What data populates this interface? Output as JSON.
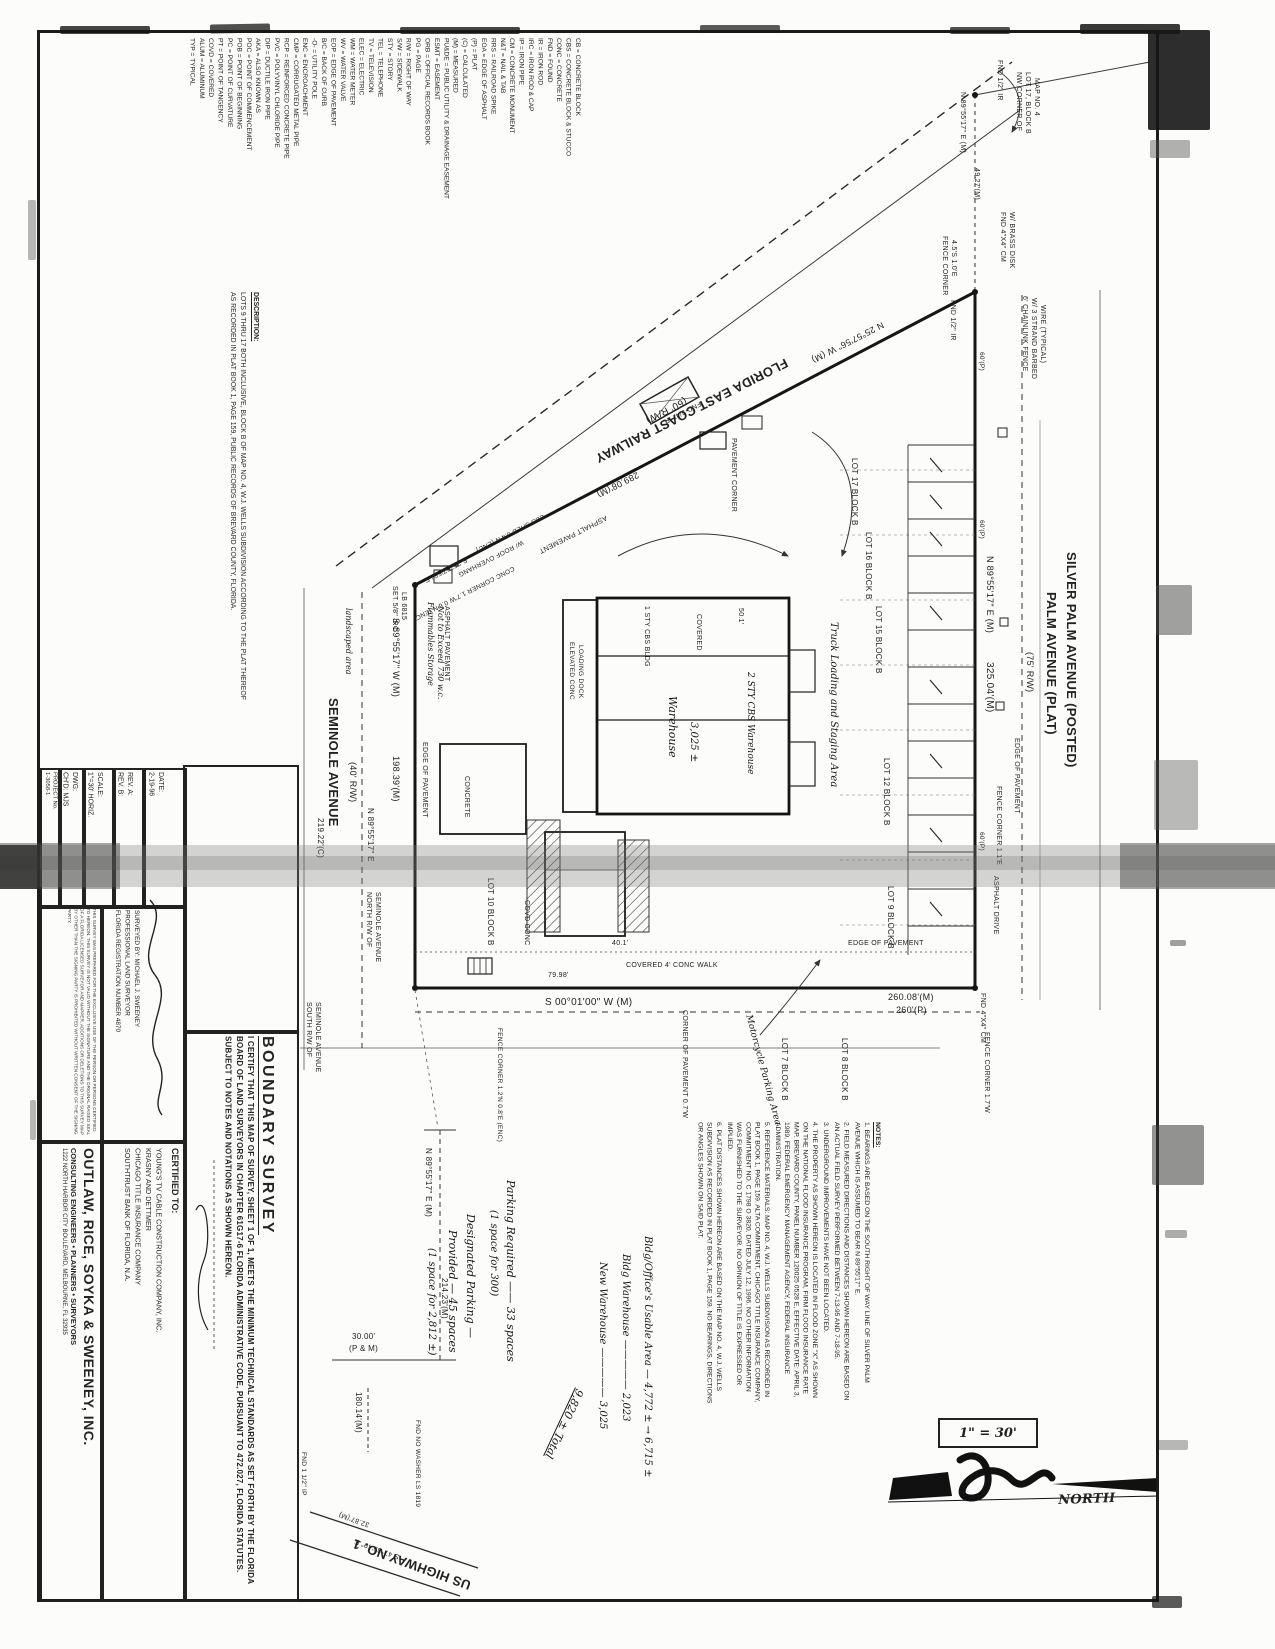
{
  "document": {
    "title": "BOUNDARY SURVEY",
    "certification_statement": "I CERTIFY THAT THIS MAP OF SURVEY, SHEET 1 OF 1, MEETS THE MINIMUM TECHNICAL STANDARDS AS SET FORTH BY THE FLORIDA BOARD OF LAND SURVEYORS IN CHAPTER 61G17-6 FLORIDA ADMINISTRATIVE CODE, PURSUANT TO 472.027, FLORIDA STATUTES. SUBJECT TO NOTES AND NOTATIONS AS SHOWN HEREON.",
    "certified_to_label": "CERTIFIED TO:",
    "certified_to": [
      "YOUNG'S TV CABLE CONSTRUCTION COMPANY, INC.",
      "KRASNY AND DETTMER",
      "CHICAGO TITLE INSURANCE COMPANY",
      "SOUTHTRUST BANK OF FLORIDA, N.A."
    ]
  },
  "company": {
    "name": "OUTLAW, RICE, SOYKA & SWEENEY, INC.",
    "tagline": "CONSULTING ENGINEERS • PLANNERS • SURVEYORS",
    "address": "1222 NORTH HARBOR CITY BOULEVARD, MELBOURNE, FL 32935"
  },
  "title_block": {
    "date_label": "DATE:",
    "date": "2-19-96",
    "rev_a": "REV. A:",
    "rev_b": "REV. B:",
    "scale_label": "SCALE:",
    "scale": "1\"=30' HORIZ.",
    "dwg_label": "DWG:",
    "chd_label": "CH'D: MJS",
    "project_label": "PROJECT No.",
    "project": "1-3058-1",
    "surveyed_by": "SURVEYED BY: MICHAEL J. SWEENEY",
    "surveyor_title": "PROFESSIONAL LAND SURVEYOR",
    "registration": "FLORIDA REGISTRATION NUMBER 4870",
    "disclaimer": "THIS SURVEY WAS PREPARED FOR THE EXCLUSIVE USE OF THE PERSON OR PERSONS CERTIFIED TO HEREON. THIS SURVEY IS NOT VALID WITHOUT THE SIGNATURE AND THE ORIGINAL RAISED SEAL OF A FLORIDA LICENSED SURVEYOR AND MAPPER. ADDITIONS OR DELETIONS TO THIS SURVEY MAP BY OTHER THAN THE SIGNING PARTY IS PROHIBITED WITHOUT WRITTEN CONSENT OF THE SIGNING PARTY."
  },
  "legend": {
    "items": [
      "CB = CONCRETE BLOCK",
      "CBS = CONCRETE BLOCK & STUCCO",
      "CONC = CONCRETE",
      "FND = FOUND",
      "IR = IRON ROD",
      "IRC = IRON ROD & CAP",
      "IP = IRON PIPE",
      "CM = CONCRETE MONUMENT",
      "N&T = NAIL & TAB",
      "RRS = RAILROAD SPIKE",
      "EOA = EDGE OF ASPHALT",
      "(P) = PLAT",
      "(C) = CALCULATED",
      "(M) = MEASURED",
      "PU&DE = PUBLIC UTILITY & DRAINAGE EASEMENT",
      "ESMT = EASEMENT",
      "ORB = OFFICIAL RECORDS BOOK",
      "PG = PAGE",
      "R/W = RIGHT OF WAY",
      "S/W = SIDEWALK",
      "STY = STORY",
      "TEL = TELEPHONE",
      "TV = TELEVISION",
      "ELEC = ELECTRIC",
      "WM = WATER METER",
      "WV = WATER VALVE",
      "EOP = EDGE OF PAVEMENT",
      "B/C = BACK OF CURB",
      "-O- = UTILITY POLE",
      "ENC = ENCROACHMENT",
      "CMP = CORRUGATED METAL PIPE",
      "RCP = REINFORCED CONCRETE PIPE",
      "PVC = POLYVINYL CHLORIDE PIPE",
      "DIP = DUCTILE IRON PIPE",
      "AKA = ALSO KNOWN AS",
      "POC = POINT OF COMMENCEMENT",
      "POB = POINT OF BEGINNING",
      "PC = POINT OF CURVATURE",
      "PT = POINT OF TANGENCY",
      "COVD = COVERED",
      "ALUM = ALUMINUM",
      "TYP = TYPICAL"
    ]
  },
  "description": {
    "heading": "DESCRIPTION:",
    "body": "LOTS 9 THRU 17 BOTH INCLUSIVE, BLOCK B OF MAP NO. 4, W.J. WELLS SUBDIVISION ACCORDING TO THE PLAT THEREOF AS RECORDED IN PLAT BOOK 1, PAGE 159, PUBLIC RECORDS OF BREVARD COUNTY, FLORIDA."
  },
  "notes": {
    "heading": "NOTES:",
    "items": [
      "1. BEARINGS ARE BASED ON THE SOUTH RIGHT OF WAY LINE OF SILVER PALM AVENUE WHICH IS ASSUMED TO BEAR N 89°55'17\" E.",
      "2. FIELD MEASURED DIRECTIONS AND DISTANCES SHOWN HEREON ARE BASED ON AN ACTUAL FIELD SURVEY PERFORMED BETWEEN 7-13-95 AND 7-18-95.",
      "3. UNDERGROUND IMPROVEMENTS HAVE NOT BEEN LOCATED.",
      "4. THE PROPERTY AS SHOWN HEREON IS LOCATED IN FLOOD ZONE \"X\" AS SHOWN ON THE NATIONAL FLOOD INSURANCE PROGRAM, FIRM FLOOD INSURANCE RATE MAP, BREVARD COUNTY, PANEL NUMBER 120025 0528 E, EFFECTIVE DATE: APRIL 3, 1989, FEDERAL EMERGENCY MANAGEMENT AGENCY, FEDERAL INSURANCE ADMINISTRATION.",
      "5. REFERENCE MATERIALS: MAP NO. 4, W.J. WELLS SUBDIVISION AS RECORDED IN PLAT BOOK 1, PAGE 159. ALTA COMMITMENT, CHICAGO TITLE INSURANCE COMPANY, COMMITMENT NO. C 1798 O 3820, DATED JULY 12, 1996. NO OTHER INFORMATION WAS FURNISHED TO THE SURVEYOR. NO OPINION OF TITLE IS EXPRESSED OR IMPLIED.",
      "6. PLAT DISTANCES SHOWN HEREON ARE BASED ON THE MAP NO. 4, W.J. WELLS SUBDIVISION AS RECORDED IN PLAT BOOK 1, PAGE 159. NO BEARINGS, DIRECTIONS OR ANGLES SHOWN ON SAID PLAT."
    ]
  },
  "map": {
    "scale_text": "1\" = 30'",
    "annotations": [
      {
        "t": "FLORIDA EAST COAST RAILWAY",
        "x": 790,
        "y": 368,
        "r": 153,
        "s": 13,
        "b": 1
      },
      {
        "t": "(60' R/W)",
        "x": 688,
        "y": 404,
        "r": 153,
        "s": 10
      },
      {
        "t": "N 25°57'56\" W (M)",
        "x": 885,
        "y": 328,
        "r": 153,
        "s": 9
      },
      {
        "t": "289.08'(M)",
        "x": 640,
        "y": 478,
        "r": 153,
        "s": 9
      },
      {
        "t": "S 25°57'56\" E",
        "x": 468,
        "y": 562,
        "r": 153,
        "s": 7
      },
      {
        "t": "ASPHALT PAVEMENT",
        "x": 608,
        "y": 520,
        "r": 153,
        "s": 7
      },
      {
        "t": "CBS SHED 0.4'N (ENC)",
        "x": 545,
        "y": 518,
        "r": 153,
        "s": 6.5
      },
      {
        "t": "W/ ROOF OVERHANG",
        "x": 524,
        "y": 544,
        "r": 153,
        "s": 6.5
      },
      {
        "t": "CONC CORNER 1.7'W 0.6'N (ENC)",
        "x": 515,
        "y": 570,
        "r": 153,
        "s": 6.5
      },
      {
        "t": "FND 3/4\" IP",
        "x": 702,
        "y": 406,
        "r": 153,
        "s": 7
      },
      {
        "t": "PAVEMENT CORNER",
        "x": 737,
        "y": 438,
        "r": 90,
        "s": 7
      },
      {
        "t": "SILVER PALM AVENUE (POSTED)",
        "x": 1078,
        "y": 552,
        "r": 90,
        "s": 13,
        "b": 1
      },
      {
        "t": "PALM AVENUE (PLAT)",
        "x": 1058,
        "y": 592,
        "r": 90,
        "s": 13,
        "b": 1
      },
      {
        "t": "(75' R/W)",
        "x": 1034,
        "y": 652,
        "r": 90,
        "s": 9
      },
      {
        "t": "N 89°55'17\" E (M)",
        "x": 994,
        "y": 556,
        "r": 90,
        "s": 9
      },
      {
        "t": "325.04'(M)",
        "x": 994,
        "y": 662,
        "r": 90,
        "s": 10
      },
      {
        "t": "60'(P)",
        "x": 984,
        "y": 352,
        "r": 90,
        "s": 6.5
      },
      {
        "t": "60'(P)",
        "x": 984,
        "y": 520,
        "r": 90,
        "s": 6.5
      },
      {
        "t": "60'(P)",
        "x": 984,
        "y": 832,
        "r": 90,
        "s": 6.5
      },
      {
        "t": "SEMINOLE AVENUE",
        "x": 340,
        "y": 698,
        "r": 90,
        "s": 13,
        "b": 1
      },
      {
        "t": "(40' R/W)",
        "x": 357,
        "y": 762,
        "r": 90,
        "s": 9
      },
      {
        "t": "S 89°55'17\" W (M)",
        "x": 400,
        "y": 618,
        "r": 90,
        "s": 9
      },
      {
        "t": "198.39'(M)",
        "x": 400,
        "y": 756,
        "r": 90,
        "s": 9
      },
      {
        "t": "219.22'(C)",
        "x": 324,
        "y": 818,
        "r": 90,
        "s": 8
      },
      {
        "t": "N 89°55'17\" E",
        "x": 374,
        "y": 808,
        "r": 90,
        "s": 8
      },
      {
        "t": "NORTH R/W OF",
        "x": 372,
        "y": 892,
        "r": 90,
        "s": 7
      },
      {
        "t": "SEMINOLE AVENUE",
        "x": 381,
        "y": 892,
        "r": 90,
        "s": 7
      },
      {
        "t": "SOUTH R/W OF",
        "x": 312,
        "y": 1002,
        "r": 90,
        "s": 7
      },
      {
        "t": "SEMINOLE AVENUE",
        "x": 321,
        "y": 1002,
        "r": 90,
        "s": 7
      },
      {
        "t": "S 00°01'00\" W (M)",
        "x": 545,
        "y": 998,
        "r": 0,
        "s": 10
      },
      {
        "t": "260.08'(M)",
        "x": 888,
        "y": 993,
        "r": 0,
        "s": 9
      },
      {
        "t": "260'(P)",
        "x": 896,
        "y": 1006,
        "r": 0,
        "s": 9
      },
      {
        "t": "US HIGHWAY NO. 1",
        "x": 468,
        "y": 1592,
        "r": 200,
        "s": 13,
        "b": 1
      },
      {
        "t": "FND 1/2\" IR",
        "x": 1003,
        "y": 60,
        "r": 90,
        "s": 7
      },
      {
        "t": "NW CORNER OF",
        "x": 1022,
        "y": 72,
        "r": 90,
        "s": 7
      },
      {
        "t": "LOT 17, BLOCK B",
        "x": 1031,
        "y": 72,
        "r": 90,
        "s": 7
      },
      {
        "t": "MAP NO. 4",
        "x": 1040,
        "y": 78,
        "r": 90,
        "s": 7
      },
      {
        "t": "N 89°55'17\" E (M)",
        "x": 966,
        "y": 92,
        "r": 90,
        "s": 7
      },
      {
        "t": "49.27'(M)",
        "x": 980,
        "y": 168,
        "r": 90,
        "s": 7
      },
      {
        "t": "FND 4\"X4\" CM",
        "x": 1006,
        "y": 212,
        "r": 90,
        "s": 7
      },
      {
        "t": "W/ BRASS DISK",
        "x": 1015,
        "y": 212,
        "r": 90,
        "s": 7
      },
      {
        "t": "FENCE CORNER",
        "x": 948,
        "y": 236,
        "r": 90,
        "s": 7
      },
      {
        "t": "4.5'S 1.0'E",
        "x": 957,
        "y": 240,
        "r": 90,
        "s": 7
      },
      {
        "t": "6' CHAINLINK FENCE",
        "x": 1028,
        "y": 296,
        "r": 90,
        "s": 7
      },
      {
        "t": "W/ 3 STRAND BARBED",
        "x": 1037,
        "y": 298,
        "r": 90,
        "s": 7
      },
      {
        "t": "WIRE (TYPICAL)",
        "x": 1046,
        "y": 305,
        "r": 90,
        "s": 7
      },
      {
        "t": "FND 1/2\" IR",
        "x": 956,
        "y": 300,
        "r": 90,
        "s": 7
      },
      {
        "t": "SET 5/8\" IRC",
        "x": 398,
        "y": 586,
        "r": 90,
        "s": 7
      },
      {
        "t": "LB 6815",
        "x": 407,
        "y": 592,
        "r": 90,
        "s": 7
      },
      {
        "t": "FND 4\"X4\" CM",
        "x": 986,
        "y": 993,
        "r": 90,
        "s": 7
      },
      {
        "t": "FENCE CORNER 1.1'E",
        "x": 1002,
        "y": 786,
        "r": 90,
        "s": 7
      },
      {
        "t": "FENCE CORNER 1.7'W",
        "x": 990,
        "y": 1032,
        "r": 90,
        "s": 7
      },
      {
        "t": "FENCE CORNER 1.2'N 0.8'E (ENC)",
        "x": 502,
        "y": 1028,
        "r": 90,
        "s": 6.5
      },
      {
        "t": "CORNER OF PAVEMENT 0.7'W",
        "x": 688,
        "y": 1010,
        "r": 90,
        "s": 7
      },
      {
        "t": "EDGE OF PAVEMENT",
        "x": 848,
        "y": 940,
        "r": 0,
        "s": 7
      },
      {
        "t": "EDGE OF PAVEMENT",
        "x": 428,
        "y": 742,
        "r": 90,
        "s": 7
      },
      {
        "t": "EDGE OF PAVEMENT",
        "x": 1020,
        "y": 738,
        "r": 90,
        "s": 7
      },
      {
        "t": "COVERED 4' CONC WALK",
        "x": 626,
        "y": 962,
        "r": 0,
        "s": 7
      },
      {
        "t": "ASPHALT PAVEMENT",
        "x": 450,
        "y": 606,
        "r": 90,
        "s": 7
      },
      {
        "t": "ASPHALT DRIVE",
        "x": 999,
        "y": 876,
        "r": 90,
        "s": 7
      },
      {
        "t": "CONCRETE",
        "x": 470,
        "y": 776,
        "r": 90,
        "s": 7
      },
      {
        "t": "COVD CONC",
        "x": 530,
        "y": 900,
        "r": 90,
        "s": 7
      },
      {
        "t": "1 STY CBS BLDG",
        "x": 650,
        "y": 606,
        "r": 90,
        "s": 7
      },
      {
        "t": "COVERED",
        "x": 702,
        "y": 614,
        "r": 90,
        "s": 7
      },
      {
        "t": "ELEVATED CONC",
        "x": 574,
        "y": 642,
        "r": 90,
        "s": 6.5
      },
      {
        "t": "LOADING DOCK",
        "x": 583,
        "y": 645,
        "r": 90,
        "s": 6.5
      },
      {
        "t": "79.98'",
        "x": 548,
        "y": 972,
        "r": 0,
        "s": 7
      },
      {
        "t": "40.1'",
        "x": 612,
        "y": 940,
        "r": 0,
        "s": 7
      },
      {
        "t": "50.1'",
        "x": 744,
        "y": 608,
        "r": 90,
        "s": 7
      },
      {
        "t": "LOT 17 BLOCK B",
        "x": 858,
        "y": 458,
        "r": 90,
        "s": 8
      },
      {
        "t": "LOT 16 BLOCK B",
        "x": 872,
        "y": 532,
        "r": 90,
        "s": 8
      },
      {
        "t": "LOT 15 BLOCK B",
        "x": 882,
        "y": 606,
        "r": 90,
        "s": 8
      },
      {
        "t": "LOT 12 BLOCK B",
        "x": 890,
        "y": 758,
        "r": 90,
        "s": 8
      },
      {
        "t": "LOT 9 BLOCK B",
        "x": 894,
        "y": 886,
        "r": 90,
        "s": 8
      },
      {
        "t": "LOT 10 BLOCK B",
        "x": 494,
        "y": 878,
        "r": 90,
        "s": 8
      },
      {
        "t": "LOT 8 BLOCK B",
        "x": 848,
        "y": 1038,
        "r": 90,
        "s": 8
      },
      {
        "t": "LOT 7 BLOCK B",
        "x": 788,
        "y": 1038,
        "r": 90,
        "s": 8
      },
      {
        "t": "N 89°55'17\" E (M)",
        "x": 432,
        "y": 1148,
        "r": 90,
        "s": 8
      },
      {
        "t": "214.23'(M)",
        "x": 448,
        "y": 1278,
        "r": 90,
        "s": 8
      },
      {
        "t": "30.00'",
        "x": 352,
        "y": 1333,
        "r": 0,
        "s": 8
      },
      {
        "t": "(P & M)",
        "x": 349,
        "y": 1345,
        "r": 0,
        "s": 8
      },
      {
        "t": "180.14'(M)",
        "x": 362,
        "y": 1392,
        "r": 90,
        "s": 8
      },
      {
        "t": "FND 1 1/2\" IP",
        "x": 306,
        "y": 1452,
        "r": 90,
        "s": 6.5
      },
      {
        "t": "FND NO WASHER LS 1819",
        "x": 420,
        "y": 1420,
        "r": 90,
        "s": 6.5
      },
      {
        "t": "32.87'(M)",
        "x": 368,
        "y": 1528,
        "r": 200,
        "s": 7
      },
      {
        "t": "S 47°39'49\" E",
        "x": 398,
        "y": 1560,
        "r": 200,
        "s": 7
      },
      {
        "t": "NORTH",
        "x": 1058,
        "y": 1494,
        "r": -2,
        "s": 13,
        "b": 1,
        "i": 1
      },
      {
        "t": "Truck Loading and Staging Area",
        "x": 838,
        "y": 622,
        "r": 90,
        "s": 10,
        "h": 1
      },
      {
        "t": "Motorcycle Parking Area",
        "x": 752,
        "y": 1014,
        "r": 75,
        "s": 9,
        "h": 1
      },
      {
        "t": "Warehouse",
        "x": 678,
        "y": 696,
        "r": 90,
        "s": 11,
        "h": 1
      },
      {
        "t": "3,025 ±",
        "x": 698,
        "y": 722,
        "r": 90,
        "s": 10,
        "h": 1
      },
      {
        "t": "2 STY CBS Warehouse",
        "x": 754,
        "y": 672,
        "r": 90,
        "s": 9,
        "h": 1
      },
      {
        "t": "Flammables Storage",
        "x": 434,
        "y": 602,
        "r": 90,
        "s": 8,
        "h": 1
      },
      {
        "t": "Not to Exceed 730 w.c.",
        "x": 444,
        "y": 606,
        "r": 90,
        "s": 8,
        "h": 1
      },
      {
        "t": "landscaped area",
        "x": 352,
        "y": 608,
        "r": 90,
        "s": 8,
        "h": 1
      },
      {
        "t": "Parking Required —— 33 spaces",
        "x": 516,
        "y": 1180,
        "r": 90,
        "s": 11,
        "h": 1
      },
      {
        "t": "(1 space for 300)",
        "x": 498,
        "y": 1210,
        "r": 90,
        "s": 10,
        "h": 1
      },
      {
        "t": "Designated Parking —",
        "x": 476,
        "y": 1214,
        "r": 90,
        "s": 11,
        "h": 1
      },
      {
        "t": "Provided — 45 spaces",
        "x": 458,
        "y": 1230,
        "r": 90,
        "s": 11,
        "h": 1
      },
      {
        "t": "(1 space for 2,812 ±)",
        "x": 436,
        "y": 1248,
        "r": 90,
        "s": 10,
        "h": 1
      },
      {
        "t": "Bldg/Office's Usable Area — 4,772 ± → 6,715 ±",
        "x": 652,
        "y": 1236,
        "r": 90,
        "s": 10,
        "h": 1
      },
      {
        "t": "Bldg Warehouse ————— 2,023",
        "x": 630,
        "y": 1254,
        "r": 90,
        "s": 10,
        "h": 1
      },
      {
        "t": "New Warehouse ————— 3,025",
        "x": 607,
        "y": 1262,
        "r": 90,
        "s": 10,
        "h": 1
      },
      {
        "t": "9,820 ± Total",
        "x": 585,
        "y": 1392,
        "r": 115,
        "s": 11,
        "h": 1,
        "u": 1
      }
    ]
  }
}
